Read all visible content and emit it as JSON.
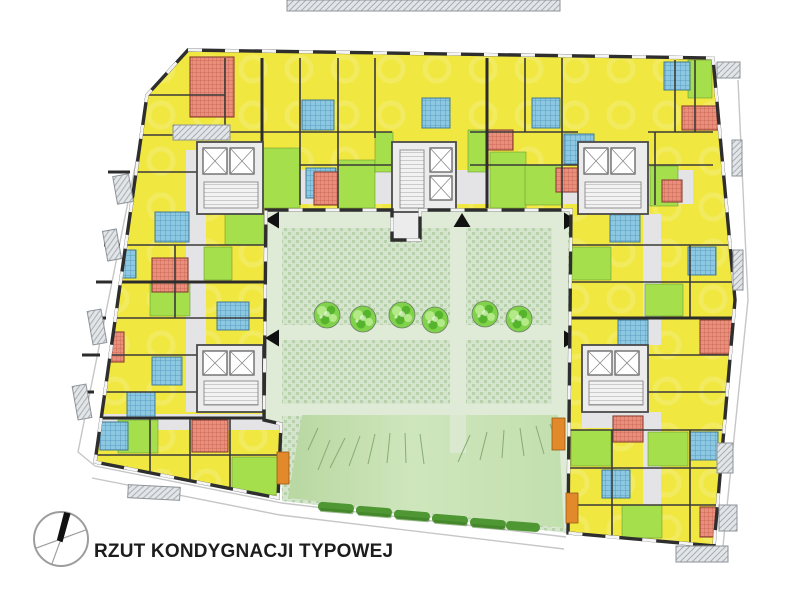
{
  "title": "RZUT KONDYGNACJI TYPOWEJ",
  "colors": {
    "background": "#ffffff",
    "wall": "#2e2e2e",
    "room_yellow": "#f0e740",
    "kitchen_green": "#a5df4c",
    "bathroom_blue": "#8cc8e2",
    "bathroom_tile": "#4e93bb",
    "special_salmon": "#e98f7c",
    "special_hatch": "#c65f4e",
    "core_gray": "#ececec",
    "corridor_gray": "#e4e4e6",
    "paving_light": "#d5e4cd",
    "paving_dot": "#b7d1aa",
    "path_green": "#dfead7",
    "lawn_green": "#c6e0b2",
    "lawn_stroke": "#7fa06c",
    "hedge_green": "#4e9733",
    "tree_green": "#7fd24a",
    "tree_light": "#b4e987",
    "tree_dark": "#55b32c",
    "balcony_hatch": "#a7adb2",
    "orange": "#e2892b",
    "arrow_black": "#111111"
  },
  "compass": {
    "needle_angle_deg": 13
  },
  "courtyard": {
    "tree_radius": 13,
    "trees": [
      {
        "x": 327,
        "y": 315
      },
      {
        "x": 363,
        "y": 319
      },
      {
        "x": 402,
        "y": 315
      },
      {
        "x": 435,
        "y": 320
      },
      {
        "x": 485,
        "y": 314
      },
      {
        "x": 519,
        "y": 319
      }
    ],
    "arrows": [
      {
        "x": 273,
        "y": 220,
        "dir": "left"
      },
      {
        "x": 273,
        "y": 338,
        "dir": "left"
      },
      {
        "x": 462,
        "y": 221,
        "dir": "up"
      },
      {
        "x": 570,
        "y": 221,
        "dir": "right"
      },
      {
        "x": 570,
        "y": 339,
        "dir": "right"
      }
    ]
  }
}
